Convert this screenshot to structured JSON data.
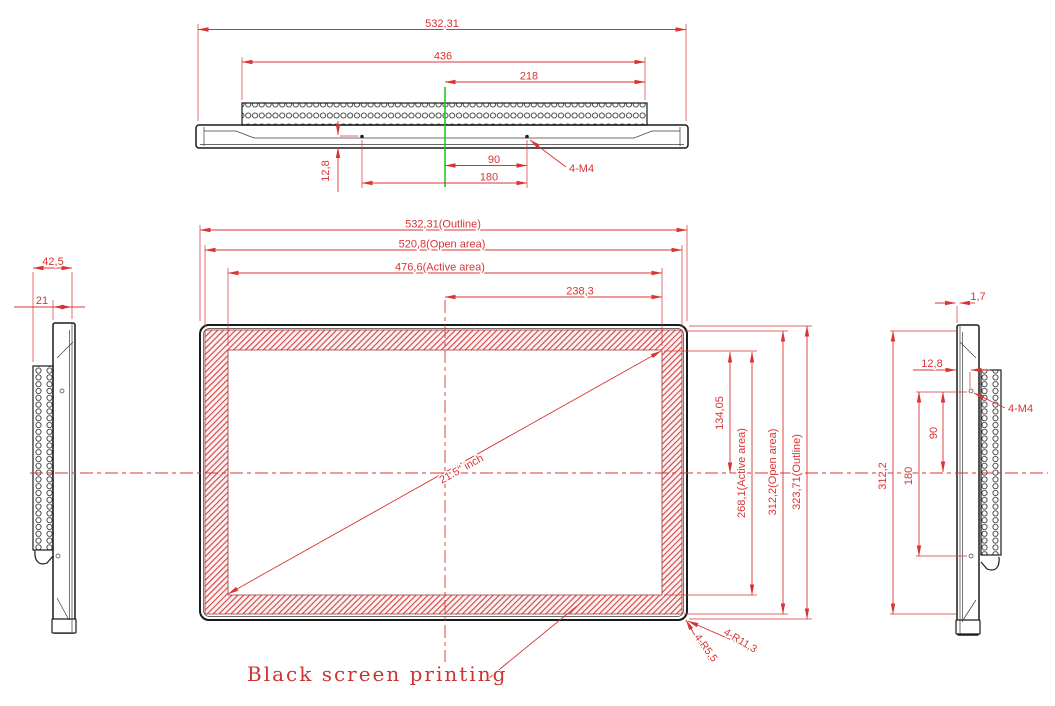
{
  "colors": {
    "dimension_red": "#d93434",
    "centerline_green": "#1ecb1e",
    "object_line": "#1a1a1a",
    "hatch_line": "#cc4444",
    "hatch_fill": "#fdf1f1",
    "background": "#ffffff"
  },
  "top_view": {
    "dims": {
      "outline_width": "532,31",
      "vent_width": "436",
      "vent_half_width": "218",
      "hole_inset": "12,8",
      "hole_to_center": "90",
      "hole_spacing": "180",
      "mount_hole_callout": "4-M4"
    }
  },
  "front_view": {
    "dims": {
      "outline_width": "532,31(Outline)",
      "open_width": "520,8(Open area)",
      "active_width": "476,6(Active area)",
      "active_half_width": "238,3",
      "active_half_height": "134,05",
      "active_height": "268,1(Active area)",
      "open_height": "312,2(Open area)",
      "outline_height": "323,71(Outline)",
      "diagonal_size": "21.5\" inch",
      "corner_radius_small": "4-R5,5",
      "corner_radius_large": "4-R11,3"
    },
    "note": "Black screen printing"
  },
  "left_view": {
    "dims": {
      "total_depth": "42,5",
      "body_depth": "21"
    }
  },
  "right_view": {
    "dims": {
      "glass_lip": "1,7",
      "hole_inset": "12,8",
      "hole_to_center": "90",
      "hole_spacing": "180",
      "open_height": "312,2",
      "mount_hole_callout": "4-M4"
    }
  }
}
